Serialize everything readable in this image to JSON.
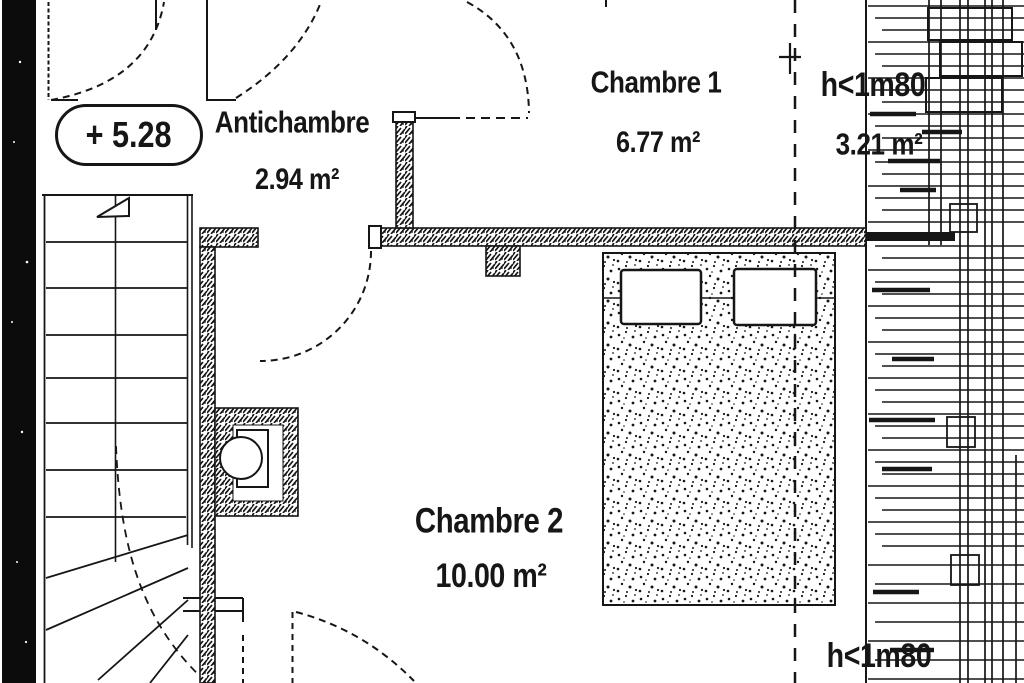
{
  "plan": {
    "level_marker": "+ 5.28",
    "rooms": [
      {
        "name": "Antichambre",
        "area": "2.94 m²"
      },
      {
        "name": "Chambre 1",
        "area": "6.77 m²"
      },
      {
        "name": "Chambre 2",
        "area": "10.00 m²"
      }
    ],
    "low_ceiling": {
      "label_top": "h<1m80",
      "area": "3.21 m²",
      "label_bottom": "h<1m80"
    },
    "colors": {
      "ink": "#161616",
      "paper": "#ffffff"
    }
  }
}
